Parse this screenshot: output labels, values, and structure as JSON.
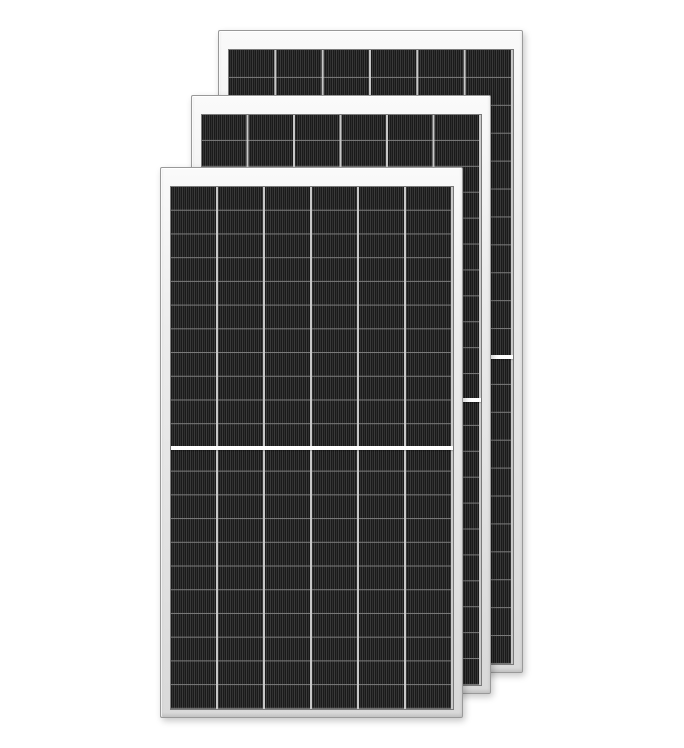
{
  "meta": {
    "description": "Product render of three overlapping silver-framed half-cut monocrystalline solar panels on a white background, stacked front to back with an upward-right offset",
    "image_type": "product-photo",
    "text_content": "none"
  },
  "theme": {
    "bg": "#ffffff",
    "frame_hi": "#fafafa",
    "frame_face": "#ececec",
    "frame_low": "#d9d9d9",
    "frame_edge": "#999999",
    "cell_base": "#262626",
    "cell_dark": "#1a1a1a",
    "cell_mid": "#2f2f2f",
    "cell_light": "#3a3a3a",
    "row_line": "#7d7d7d",
    "col_line": "#c8c8c8",
    "divider": "#ffffff"
  },
  "panels": [
    {
      "label": "solar panel, back of stack",
      "frame": "silver aluminum",
      "cell_columns": 6,
      "cell_rows": 22,
      "half_cut_divider": "white horizontal gap at vertical center"
    },
    {
      "label": "solar panel, middle of stack",
      "frame": "silver aluminum",
      "cell_columns": 6,
      "cell_rows": 22,
      "half_cut_divider": "white horizontal gap at vertical center"
    },
    {
      "label": "solar panel, front of stack",
      "frame": "silver aluminum",
      "cell_columns": 6,
      "cell_rows": 22,
      "half_cut_divider": "white horizontal gap at vertical center"
    }
  ]
}
